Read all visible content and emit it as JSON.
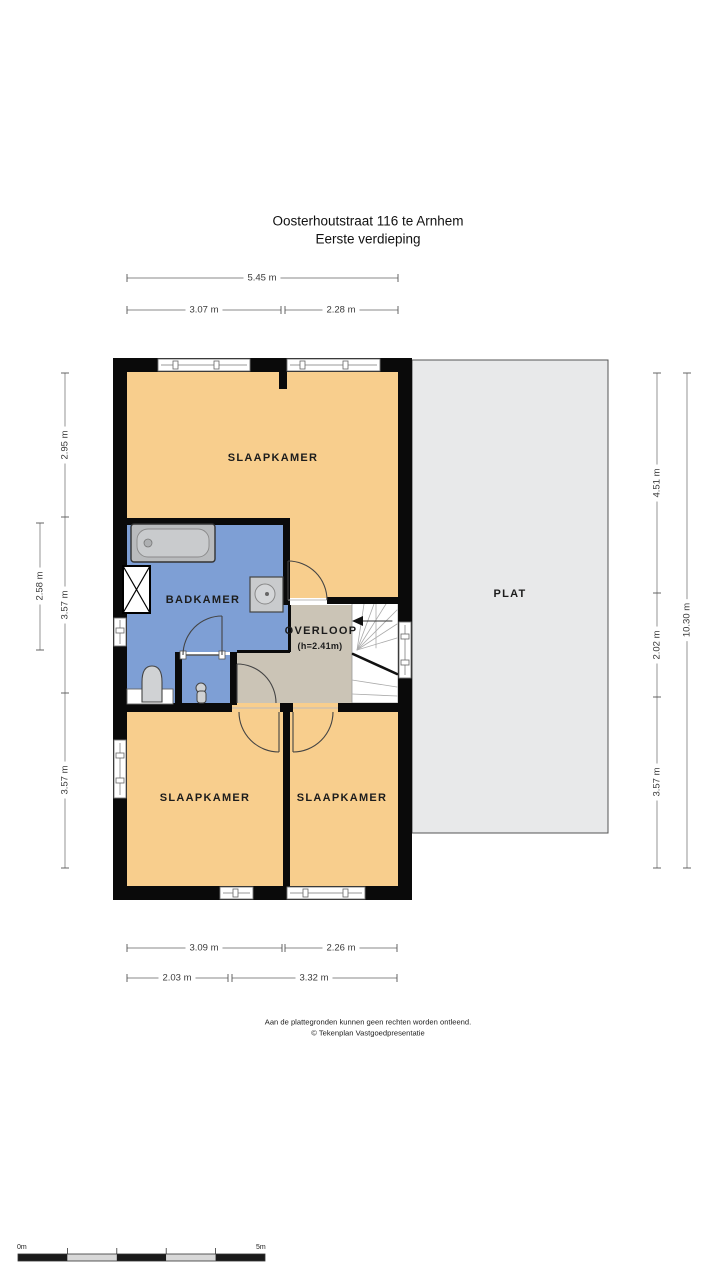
{
  "title": {
    "line1": "Oosterhoutstraat 116 te Arnhem",
    "line2": "Eerste verdieping"
  },
  "rooms": {
    "slaapkamer_top": "SLAAPKAMER",
    "badkamer": "BADKAMER",
    "overloop": "OVERLOOP",
    "overloop_height": "(h=2.41m)",
    "slaapkamer_bottom_left": "SLAAPKAMER",
    "slaapkamer_bottom_right": "SLAAPKAMER",
    "plat": "PLAT"
  },
  "dimensions": {
    "top_total": "5.45 m",
    "top_left": "3.07 m",
    "top_right": "2.28 m",
    "left_upper": "2.95 m",
    "left_outer": "2.58 m",
    "left_middle": "3.57 m",
    "left_lower": "3.57 m",
    "right_upper": "4.51 m",
    "right_middle": "2.02 m",
    "right_lower": "3.57 m",
    "right_total": "10.30 m",
    "bottom_upper_left": "3.09 m",
    "bottom_upper_right": "2.26 m",
    "bottom_lower_left": "2.03 m",
    "bottom_lower_right": "3.32 m"
  },
  "footer": {
    "disclaimer": "Aan de plattegronden kunnen geen rechten worden ontleend.",
    "copyright": "© Tekenplan Vastgoedpresentatie"
  },
  "scale_bar": {
    "start_label": "0m",
    "end_label": "5m"
  },
  "colors": {
    "bedroom_fill": "#F8CE8D",
    "bathroom_fill": "#7E9FD5",
    "landing_fill": "#CBC4B6",
    "flat_roof_fill": "#E8E9EA",
    "wall": "#0A0A0A"
  }
}
